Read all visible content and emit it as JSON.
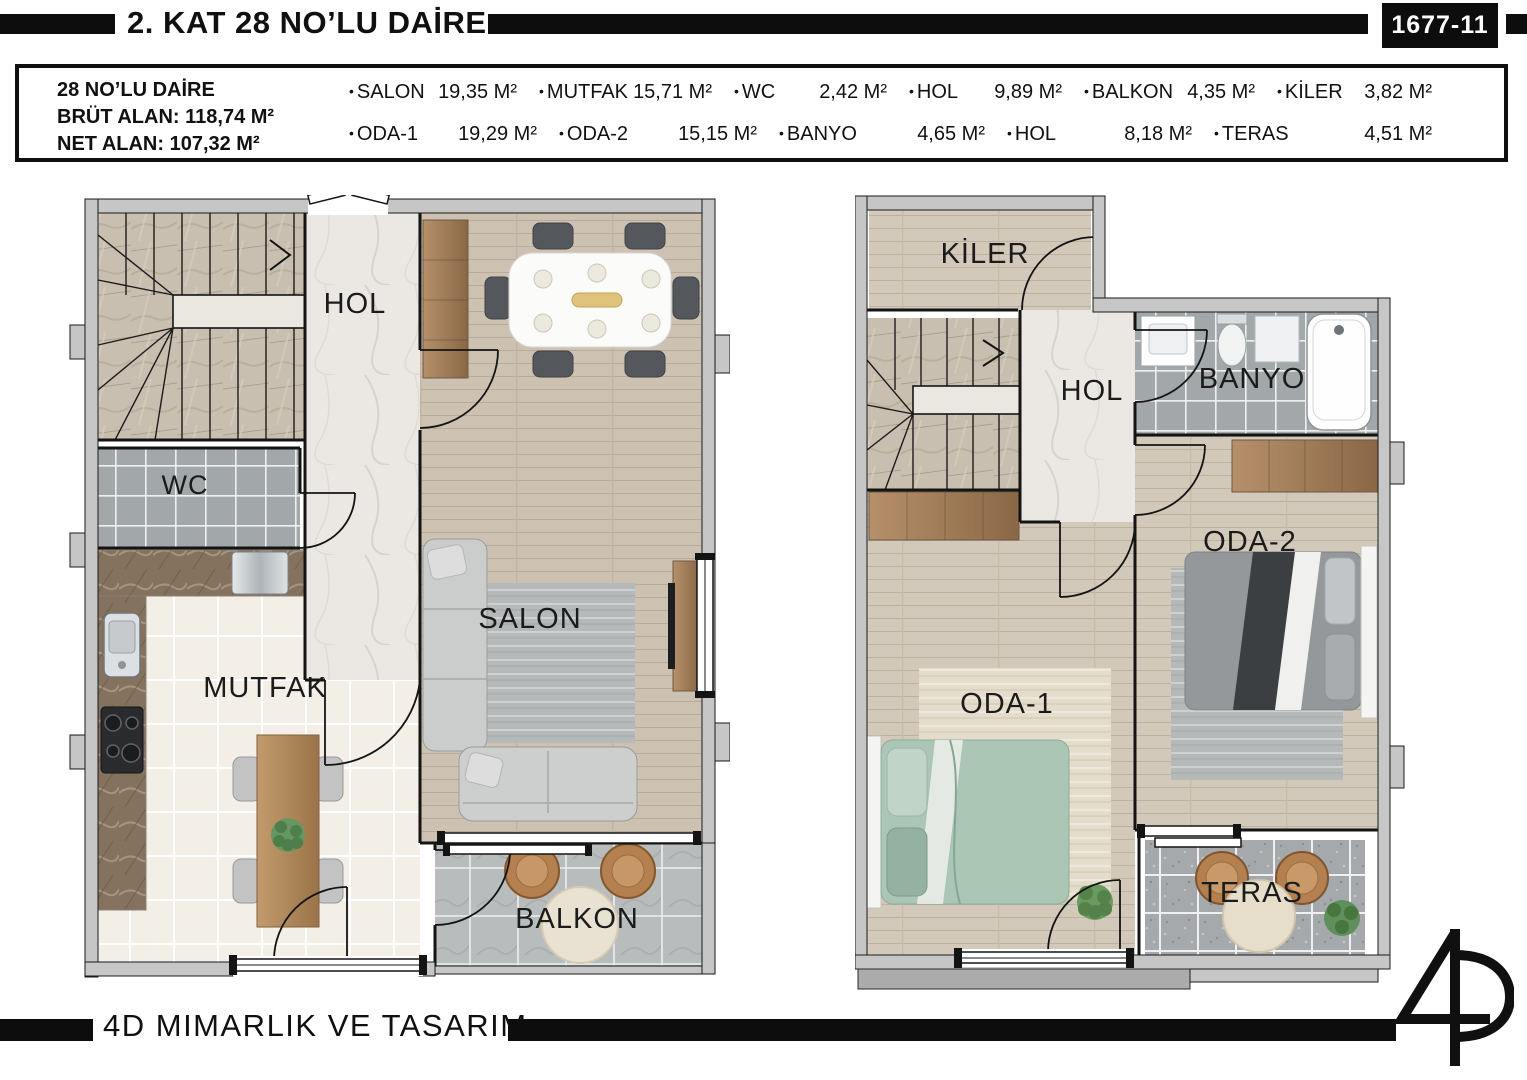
{
  "header": {
    "title": "2. KAT 28 NO’LU DAİRE",
    "sheet_no": "1677-11"
  },
  "summary": {
    "apartment_label": "28 NO’LU DAİRE",
    "gross_area": "BRÜT ALAN: 118,74 M²",
    "net_area": "NET ALAN: 107,32 M²",
    "rooms_row1": [
      {
        "name": "SALON",
        "area": "19,35 M²"
      },
      {
        "name": "MUTFAK",
        "area": "15,71 M²"
      },
      {
        "name": "WC",
        "area": "2,42 M²"
      },
      {
        "name": "HOL",
        "area": "9,89 M²"
      },
      {
        "name": "BALKON",
        "area": "4,35 M²"
      },
      {
        "name": "KİLER",
        "area": "3,82 M²"
      }
    ],
    "rooms_row2": [
      {
        "name": "ODA-1",
        "area": "19,29 M²"
      },
      {
        "name": "ODA-2",
        "area": "15,15 M²"
      },
      {
        "name": "BANYO",
        "area": "4,65 M²"
      },
      {
        "name": "HOL",
        "area": "8,18 M²"
      },
      {
        "name": "TERAS",
        "area": "4,51 M²"
      }
    ]
  },
  "plan_lower": {
    "labels": {
      "hol": "HOL",
      "wc": "WC",
      "mutfak": "MUTFAK",
      "salon": "SALON",
      "balkon": "BALKON"
    }
  },
  "plan_upper": {
    "labels": {
      "kiler": "KİLER",
      "hol": "HOL",
      "banyo": "BANYO",
      "oda2": "ODA-2",
      "oda1": "ODA-1",
      "teras": "TERAS"
    }
  },
  "footer": {
    "company": "4D MIMARLIK VE TASARIM"
  },
  "colors": {
    "accent_black": "#0d0d0d",
    "wall_gray": "#c6c6c6",
    "wood_floor": "#cdc2b2",
    "tile_gray": "#a2a7aa"
  }
}
